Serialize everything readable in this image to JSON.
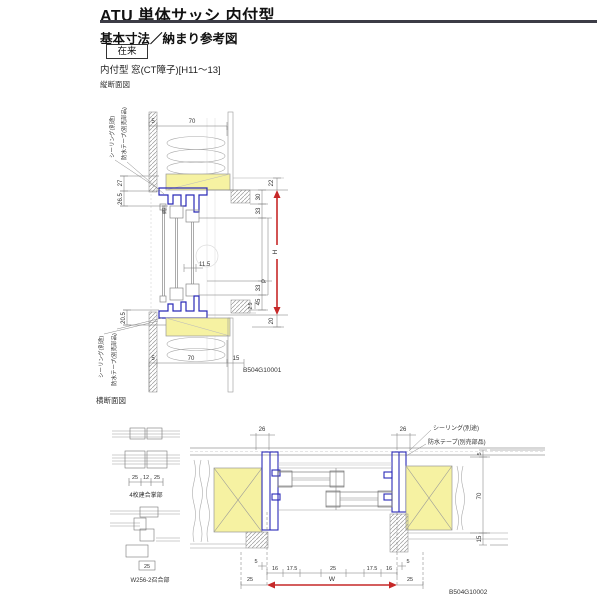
{
  "header": {
    "title": "ATU 単体サッシ 内付型",
    "subtitle": "基本寸法／納まり参考図",
    "badge": "在来",
    "spec": "内付型 窓(CT障子)[H11〜13]"
  },
  "vertical_section": {
    "caption": "縦断面図",
    "code": "B504G10001",
    "callout_seal_top": "シーリング(別途)",
    "callout_tape_top": "防水テープ(別売部品)",
    "callout_seal_bottom": "シーリング(別途)",
    "callout_tape_bottom": "防水テープ(別売部品)",
    "label_screen": "網戸",
    "dim_top_5": "5",
    "dim_top_70": "70",
    "dim_left_27": "27",
    "dim_left_26_5": "26.5",
    "dim_left_20_5": "20.5",
    "dim_right_22": "22",
    "dim_right_30": "30",
    "dim_right_33_upper": "33",
    "dim_right_P": "P",
    "dim_right_33_lower": "33",
    "dim_right_45": "45",
    "dim_right_2_5": "2.5",
    "dim_right_20": "20",
    "dim_H": "H",
    "dim_mid_11_5": "11.5",
    "dim_bot_5": "5",
    "dim_bot_70": "70",
    "dim_bot_15": "15"
  },
  "horizontal_section": {
    "caption": "横断面図",
    "code": "B504G10002",
    "detail1": {
      "label": "4枚建合掌部",
      "dims": [
        "25",
        "12",
        "25"
      ]
    },
    "detail2": {
      "label": "W256-2召合部",
      "dims": [
        "25"
      ]
    },
    "callout_seal": "シーリング(別途)",
    "callout_tape": "防水テープ(別売部品)",
    "dim_top_left_26": "26",
    "dim_top_right_26": "26",
    "dim_wall_5": "5",
    "dim_wall_70": "70",
    "dim_wall_15": "15",
    "dim_row": [
      "16",
      "17.5",
      "25",
      "17.5",
      "16"
    ],
    "dim_small_5_left": "5",
    "dim_small_5_right": "5",
    "dim_out_left_25": "25",
    "dim_out_right_25": "25",
    "dim_W": "W"
  },
  "colors": {
    "accent_red": "#c62828",
    "frame_blue": "#2a2ab8",
    "wood_yellow": "#f6f2a2",
    "line_gray": "#888888",
    "text_dark": "#333333"
  }
}
